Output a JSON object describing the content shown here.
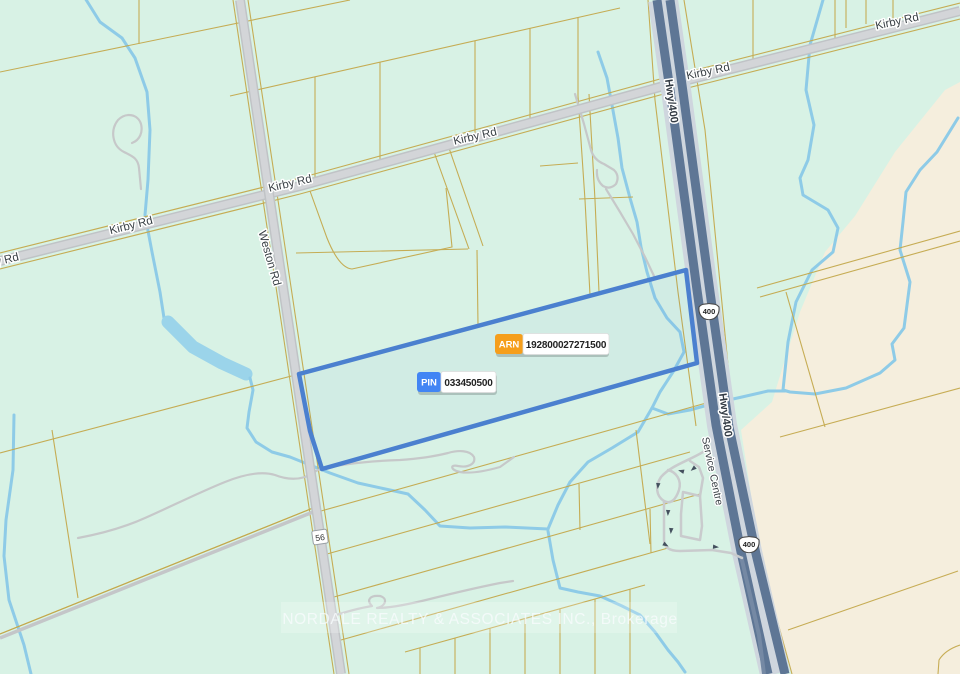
{
  "map": {
    "watermark": "NORDALE REALTY & ASSOCIATES INC., Brokerage",
    "parcel_badges": {
      "arn_label": "ARN",
      "arn_value": "192800027271500",
      "pin_label": "PIN",
      "pin_value": "033450500"
    },
    "road_labels": {
      "kirby": "Kirby Rd",
      "kirby_partial": "y Rd",
      "weston": "Weston Rd",
      "hwy400": "Hwy/400",
      "service_centre": "Service Centre"
    },
    "shields": {
      "hwy400": "400",
      "regional56": "56"
    },
    "colors": {
      "land": "#d8f2e5",
      "open_land": "#f5eedd",
      "water": "#8ecbe7",
      "lot_line": "#c4a94d",
      "road_fill": "#d3d5d8",
      "highway": "#5e7695",
      "parcel_outline": "#4b80cf",
      "arn_badge": "#f59e1b",
      "pin_badge": "#4285f4"
    }
  }
}
